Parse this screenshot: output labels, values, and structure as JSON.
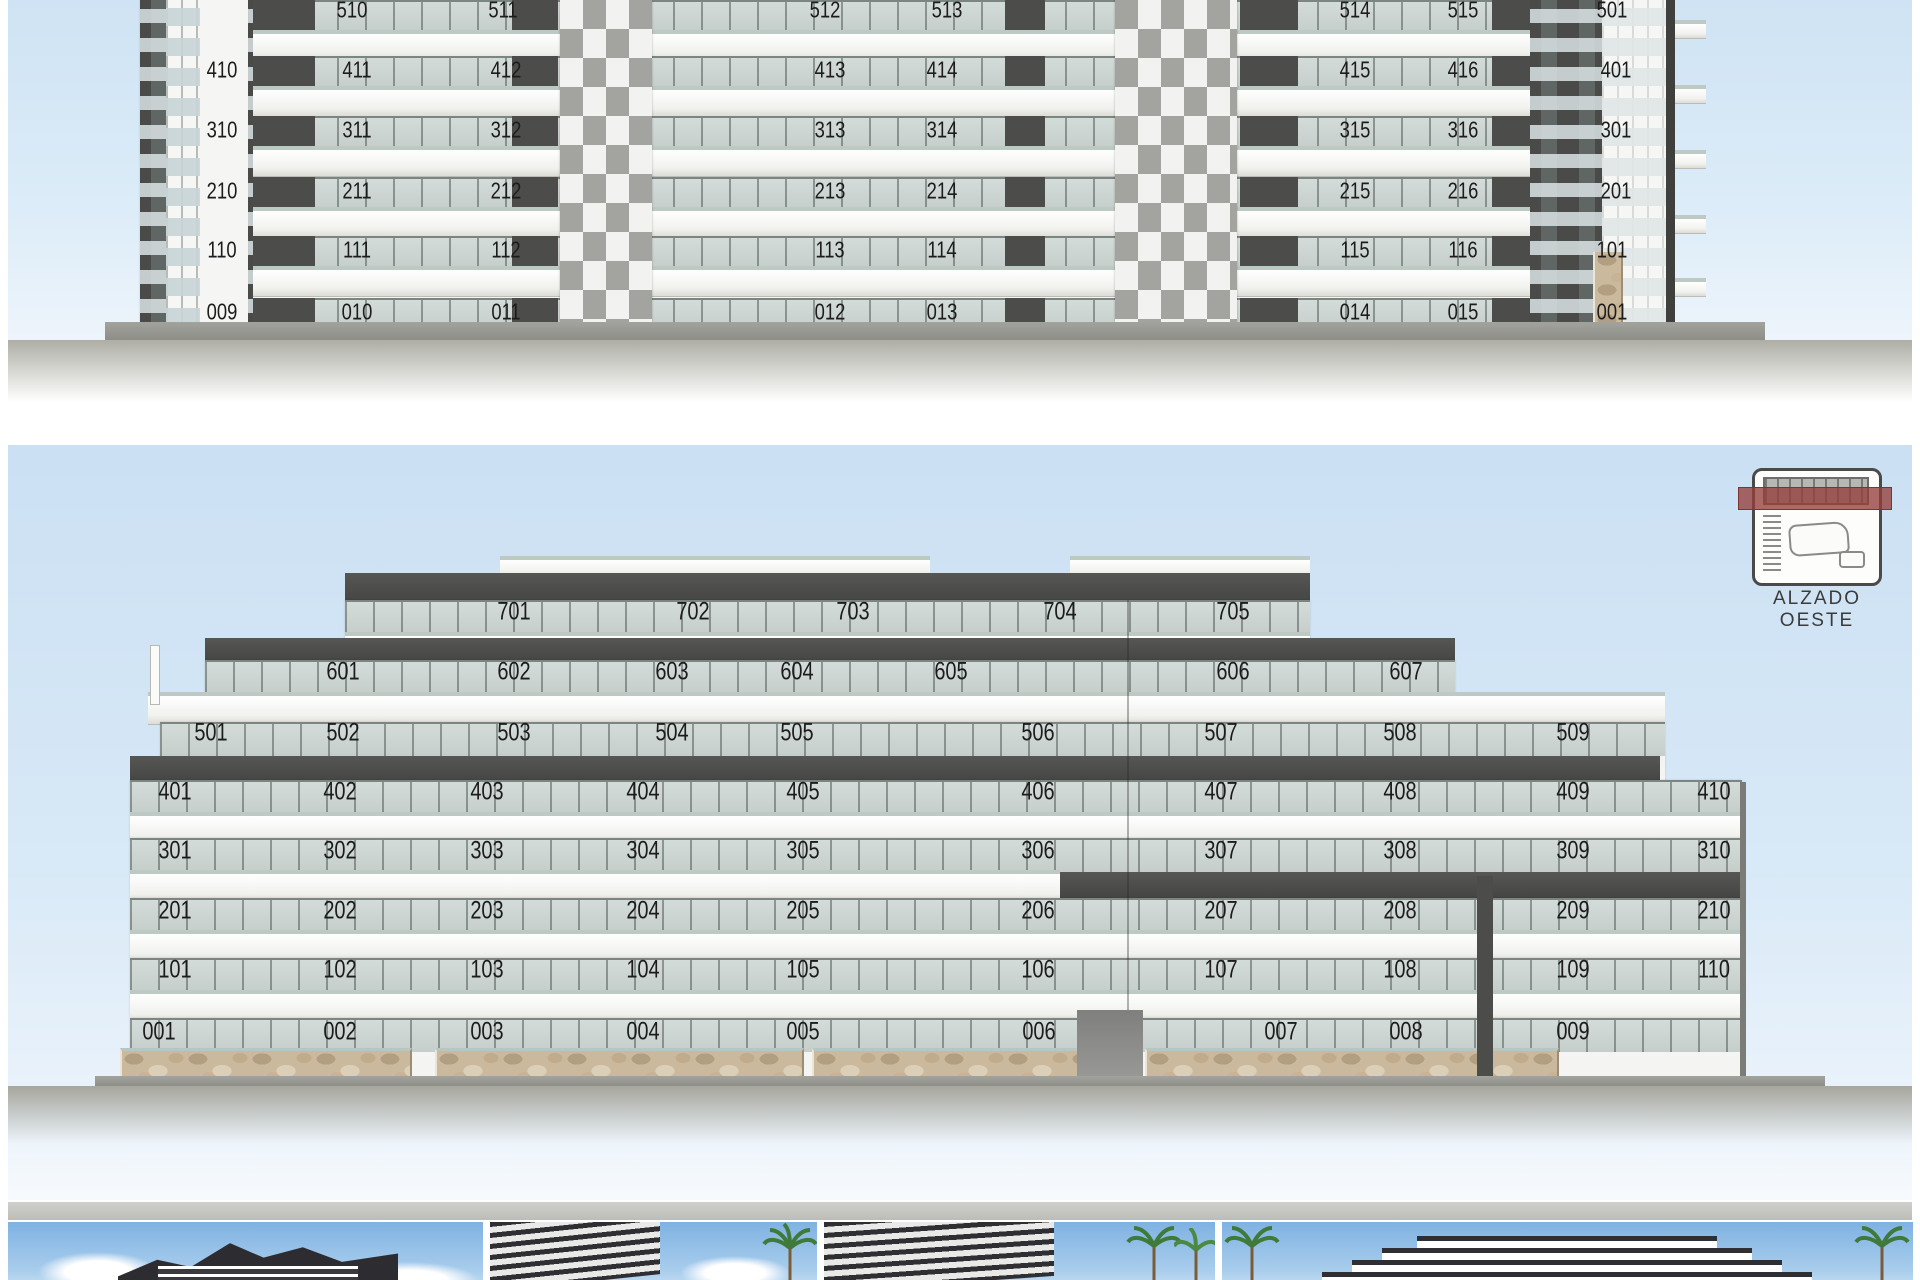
{
  "document": {
    "type": "architectural elevation sheet"
  },
  "colors": {
    "sky": "#cbe0f3",
    "facade_white": "#f4f4f2",
    "band_dark": "#4c4c4a",
    "glass": "#cdd6d3",
    "ground": "#9b9b95",
    "stone": "#cbb99e",
    "locator_red": "#943e38",
    "label_text": "#1c1c1c"
  },
  "elevation_top": {
    "name": "upper elevation (cropped at top of page)",
    "rows": [
      {
        "y": 10,
        "labels": [
          [
            "510",
            352
          ],
          [
            "511",
            503
          ],
          [
            "512",
            825
          ],
          [
            "513",
            947
          ],
          [
            "514",
            1355
          ],
          [
            "515",
            1463
          ],
          [
            "501",
            1612
          ]
        ]
      },
      {
        "y": 70,
        "labels": [
          [
            "410",
            222
          ],
          [
            "411",
            357
          ],
          [
            "412",
            506
          ],
          [
            "413",
            830
          ],
          [
            "414",
            942
          ],
          [
            "415",
            1355
          ],
          [
            "416",
            1463
          ],
          [
            "401",
            1616
          ]
        ]
      },
      {
        "y": 130,
        "labels": [
          [
            "310",
            222
          ],
          [
            "311",
            357
          ],
          [
            "312",
            506
          ],
          [
            "313",
            830
          ],
          [
            "314",
            942
          ],
          [
            "315",
            1355
          ],
          [
            "316",
            1463
          ],
          [
            "301",
            1616
          ]
        ]
      },
      {
        "y": 191,
        "labels": [
          [
            "210",
            222
          ],
          [
            "211",
            357
          ],
          [
            "212",
            506
          ],
          [
            "213",
            830
          ],
          [
            "214",
            942
          ],
          [
            "215",
            1355
          ],
          [
            "216",
            1463
          ],
          [
            "201",
            1616
          ]
        ]
      },
      {
        "y": 250,
        "labels": [
          [
            "110",
            222
          ],
          [
            "111",
            357
          ],
          [
            "112",
            506
          ],
          [
            "113",
            830
          ],
          [
            "114",
            942
          ],
          [
            "115",
            1355
          ],
          [
            "116",
            1463
          ],
          [
            "101",
            1612
          ]
        ]
      },
      {
        "y": 312,
        "labels": [
          [
            "009",
            222
          ],
          [
            "010",
            357
          ],
          [
            "011",
            506
          ],
          [
            "012",
            830
          ],
          [
            "013",
            942
          ],
          [
            "014",
            1355
          ],
          [
            "015",
            1463
          ],
          [
            "001",
            1612
          ]
        ]
      }
    ]
  },
  "elevation_west": {
    "label": "ALZADO OESTE",
    "rows": [
      {
        "y": 612,
        "labels": [
          [
            "701",
            514
          ],
          [
            "702",
            693
          ],
          [
            "703",
            853
          ],
          [
            "704",
            1060
          ],
          [
            "705",
            1233
          ]
        ]
      },
      {
        "y": 672,
        "labels": [
          [
            "601",
            343
          ],
          [
            "602",
            514
          ],
          [
            "603",
            672
          ],
          [
            "604",
            797
          ],
          [
            "605",
            951
          ],
          [
            "606",
            1233
          ],
          [
            "607",
            1406
          ]
        ]
      },
      {
        "y": 733,
        "labels": [
          [
            "501",
            211
          ],
          [
            "502",
            343
          ],
          [
            "503",
            514
          ],
          [
            "504",
            672
          ],
          [
            "505",
            797
          ],
          [
            "506",
            1038
          ],
          [
            "507",
            1221
          ],
          [
            "508",
            1400
          ],
          [
            "509",
            1573
          ]
        ]
      },
      {
        "y": 792,
        "labels": [
          [
            "401",
            175
          ],
          [
            "402",
            340
          ],
          [
            "403",
            487
          ],
          [
            "404",
            643
          ],
          [
            "405",
            803
          ],
          [
            "406",
            1038
          ],
          [
            "407",
            1221
          ],
          [
            "408",
            1400
          ],
          [
            "409",
            1573
          ],
          [
            "410",
            1714
          ]
        ]
      },
      {
        "y": 851,
        "labels": [
          [
            "301",
            175
          ],
          [
            "302",
            340
          ],
          [
            "303",
            487
          ],
          [
            "304",
            643
          ],
          [
            "305",
            803
          ],
          [
            "306",
            1038
          ],
          [
            "307",
            1221
          ],
          [
            "308",
            1400
          ],
          [
            "309",
            1573
          ],
          [
            "310",
            1714
          ]
        ]
      },
      {
        "y": 911,
        "labels": [
          [
            "201",
            175
          ],
          [
            "202",
            340
          ],
          [
            "203",
            487
          ],
          [
            "204",
            643
          ],
          [
            "205",
            803
          ],
          [
            "206",
            1038
          ],
          [
            "207",
            1221
          ],
          [
            "208",
            1400
          ],
          [
            "209",
            1573
          ],
          [
            "210",
            1714
          ]
        ]
      },
      {
        "y": 970,
        "labels": [
          [
            "101",
            175
          ],
          [
            "102",
            340
          ],
          [
            "103",
            487
          ],
          [
            "104",
            643
          ],
          [
            "105",
            803
          ],
          [
            "106",
            1038
          ],
          [
            "107",
            1221
          ],
          [
            "108",
            1400
          ],
          [
            "109",
            1573
          ],
          [
            "110",
            1714
          ]
        ]
      },
      {
        "y": 1032,
        "labels": [
          [
            "001",
            159
          ],
          [
            "002",
            340
          ],
          [
            "003",
            487
          ],
          [
            "004",
            643
          ],
          [
            "005",
            803
          ],
          [
            "006",
            1039
          ],
          [
            "007",
            1281
          ],
          [
            "008",
            1406
          ],
          [
            "009",
            1573
          ]
        ]
      }
    ]
  },
  "photos": [
    {
      "name": "render-photo-1"
    },
    {
      "name": "render-photo-2"
    },
    {
      "name": "render-photo-3"
    },
    {
      "name": "render-photo-4"
    }
  ]
}
